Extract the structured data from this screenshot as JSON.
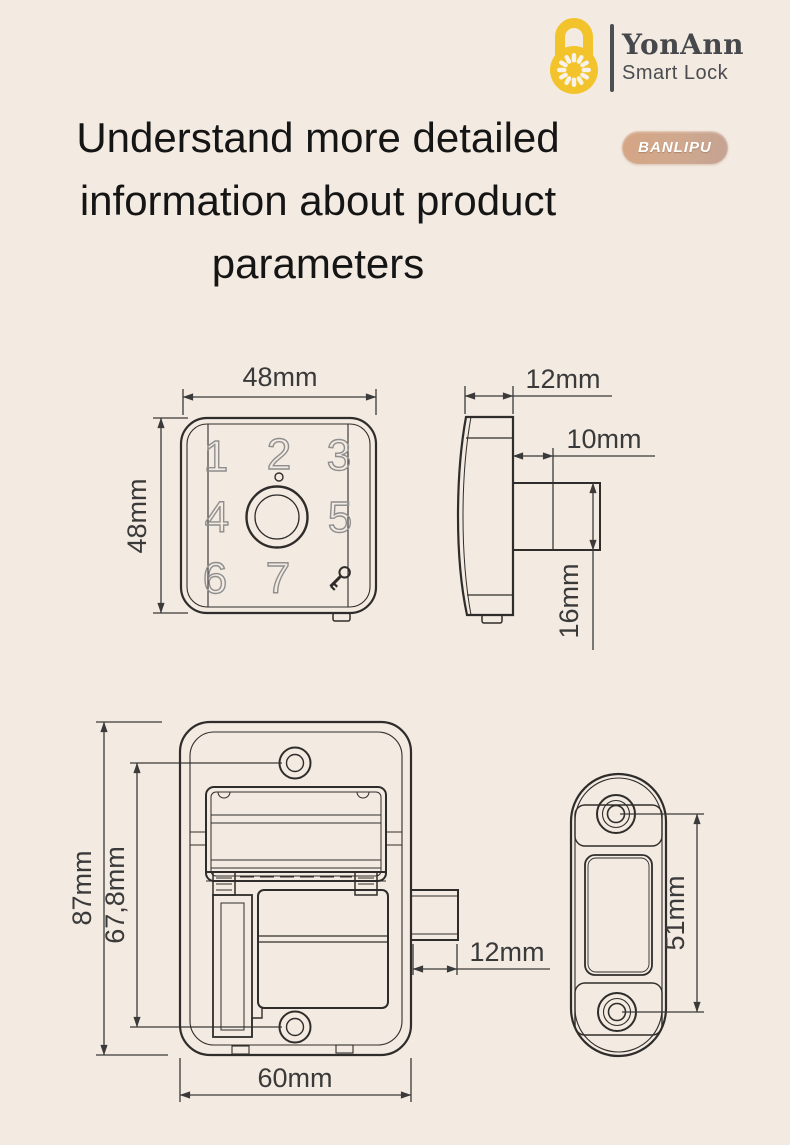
{
  "header": {
    "brand": "YonAnn",
    "brand_sub": "Smart Lock",
    "badge": "BANLIPU"
  },
  "title": {
    "line1": "Understand more detailed",
    "line2": "information about product",
    "line3": "parameters"
  },
  "colors": {
    "background": "#f3eae1",
    "drawing_line": "#2f2d2b",
    "digit_outline": "#8f8f8f",
    "dimension_text": "#3a3a3a",
    "brand_text": "#47484c",
    "lock_yellow": "#f2c32a",
    "badge_start": "#d5a685",
    "badge_end": "#c4a292",
    "badge_text": "#ffffff",
    "title_text": "#151515"
  },
  "diagrams": {
    "keypad_front": {
      "top_width": "48mm",
      "left_height": "48mm",
      "digits": [
        "1",
        "2",
        "3",
        "4",
        "5",
        "6",
        "7"
      ]
    },
    "keypad_side": {
      "panel_depth": "12mm",
      "latch_depth": "10mm",
      "latch_height": "16mm"
    },
    "lock_body": {
      "total_height": "87mm",
      "screw_spacing": "67,8mm",
      "bolt_throw": "12mm",
      "total_width": "60mm"
    },
    "strike_plate": {
      "screw_spacing": "51mm"
    }
  }
}
